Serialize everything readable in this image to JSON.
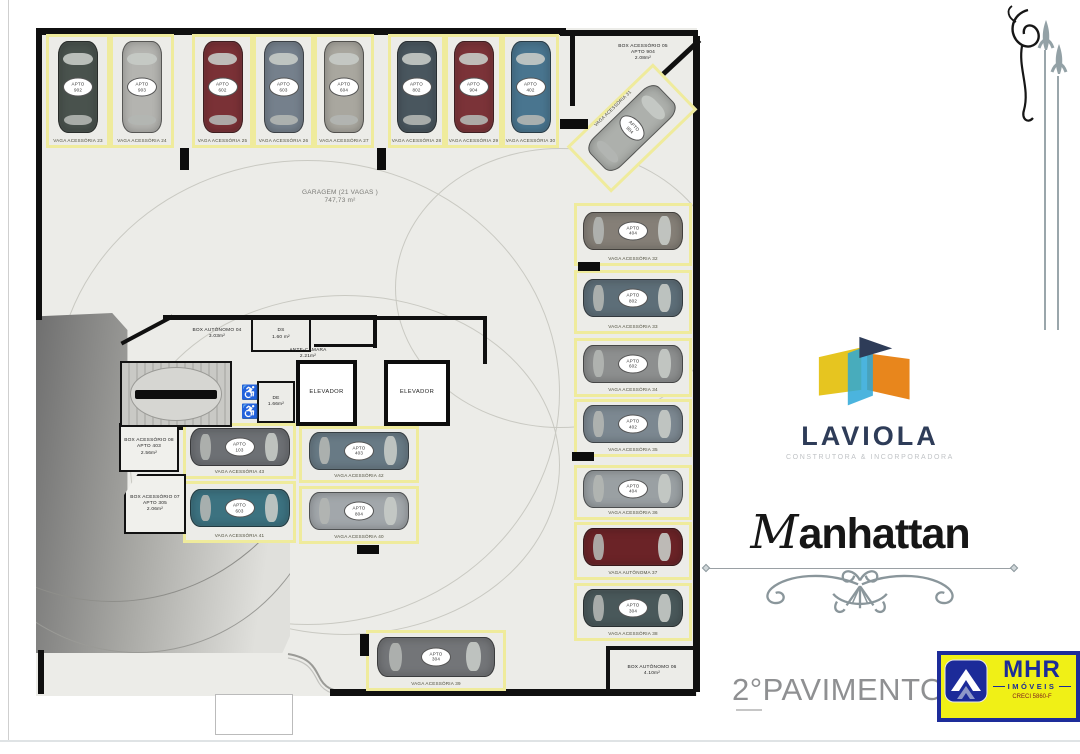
{
  "plan": {
    "apto_prefix": "APTO",
    "garagem": {
      "title": "GARAGEM (21 VAGAS )",
      "area": "747,73 m²"
    },
    "rooms": {
      "box05": {
        "line1": "BOX ACESSÓRIO 05",
        "line2": "APTO 904",
        "line3": "2.08m²"
      },
      "box04": {
        "line1": "BOX AUTÔNOMO 04",
        "line2": "3.03m²"
      },
      "ds": {
        "line1": "DS",
        "line2": "1.60 m²"
      },
      "antecamara": {
        "line1": "ANTE-CÂMARA",
        "line2": "2.21m²"
      },
      "de": {
        "line1": "DE",
        "line2": "1.66m²"
      },
      "elevator1": {
        "line1": "ELEVADOR"
      },
      "elevator2": {
        "line1": "ELEVADOR"
      },
      "box08": {
        "line1": "BOX ACESSÓRIO 08",
        "line2": "APTO 403",
        "line3": "2.56m²"
      },
      "box07": {
        "line1": "BOX ACESSÓRIO 07",
        "line2": "APTO 305",
        "line3": "2.06m²"
      },
      "box06": {
        "line1": "BOX AUTÔNOMO 06",
        "line2": "4.10m²"
      }
    },
    "spaces": [
      {
        "id": "23",
        "label": "VAGA ACESSÓRIA 23",
        "apto": "902",
        "color": "#49524d",
        "orient": "v"
      },
      {
        "id": "24",
        "label": "VAGA ACESSÓRIA 24",
        "apto": "903",
        "color": "#b4b4b0",
        "orient": "v"
      },
      {
        "id": "25",
        "label": "VAGA ACESSÓRIA 25",
        "apto": "602",
        "color": "#7a3136",
        "orient": "v"
      },
      {
        "id": "26",
        "label": "VAGA ACESSÓRIA 26",
        "apto": "603",
        "color": "#75808c",
        "orient": "v"
      },
      {
        "id": "27",
        "label": "VAGA ACESSÓRIA 27",
        "apto": "604",
        "color": "#a9a79f",
        "orient": "v"
      },
      {
        "id": "28",
        "label": "VAGA ACESSÓRIA 28",
        "apto": "802",
        "color": "#49565e",
        "orient": "v"
      },
      {
        "id": "29",
        "label": "VAGA ACESSÓRIA 29",
        "apto": "904",
        "color": "#7b3338",
        "orient": "v"
      },
      {
        "id": "30",
        "label": "VAGA ACESSÓRIA 30",
        "apto": "402",
        "color": "#49758f",
        "orient": "v"
      },
      {
        "id": "31",
        "label": "VAGA ACESSÓRIA 31",
        "apto": "904",
        "color": "#adb0ac",
        "orient": "diag"
      },
      {
        "id": "32",
        "label": "VAGA ACESSÓRIA 32",
        "apto": "404",
        "color": "#857f77",
        "orient": "h"
      },
      {
        "id": "33",
        "label": "VAGA ACESSÓRIA 33",
        "apto": "802",
        "color": "#5d6e78",
        "orient": "h"
      },
      {
        "id": "34",
        "label": "VAGA ACESSÓRIA 34",
        "apto": "602",
        "color": "#8d8f8f",
        "orient": "h"
      },
      {
        "id": "35",
        "label": "VAGA ACESSÓRIA 35",
        "apto": "402",
        "color": "#7c8891",
        "orient": "h"
      },
      {
        "id": "36",
        "label": "VAGA ACESSÓRIA 36",
        "apto": "404",
        "color": "#9aa0a3",
        "orient": "h"
      },
      {
        "id": "37",
        "label": "VAGA AUTÔNOMA 37",
        "apto": null,
        "color": "#6b2327",
        "orient": "h"
      },
      {
        "id": "38",
        "label": "VAGA ACESSÓRIA 38",
        "apto": "304",
        "color": "#49585a",
        "orient": "h"
      },
      {
        "id": "39",
        "label": "VAGA ACESSÓRIA 39",
        "apto": "304",
        "color": "#737578",
        "orient": "h"
      },
      {
        "id": "40",
        "label": "VAGA ACESSÓRIA 40",
        "apto": "804",
        "color": "#a2a7ab",
        "orient": "h"
      },
      {
        "id": "41",
        "label": "VAGA ACESSÓRIA 41",
        "apto": "603",
        "color": "#3c7280",
        "orient": "h"
      },
      {
        "id": "42",
        "label": "VAGA ACESSÓRIA 42",
        "apto": "403",
        "color": "#687a85",
        "orient": "h"
      },
      {
        "id": "43",
        "label": "VAGA ACESSÓRIA 43",
        "apto": "103",
        "color": "#6d7074",
        "orient": "h"
      }
    ]
  },
  "branding": {
    "laviola": {
      "name": "LAVIOLA",
      "tagline": "CONSTRUTORA & INCORPORADORA"
    },
    "building_initial": "M",
    "building_rest": "anhattan",
    "mhr": {
      "name": "MHR",
      "type": "IMÓVEIS",
      "creci": "CRECI 5860-F"
    },
    "colors": {
      "laviola_navy": "#2e3c58",
      "laviola_yellow": "#e6c520",
      "laviola_cyan": "#2ba7d8",
      "laviola_orange": "#e8861c",
      "mhr_blue": "#1c2b99",
      "mhr_yellow": "#f0f016"
    }
  },
  "footer": {
    "title": "2°PAVIMENTO - GARAGEM"
  }
}
